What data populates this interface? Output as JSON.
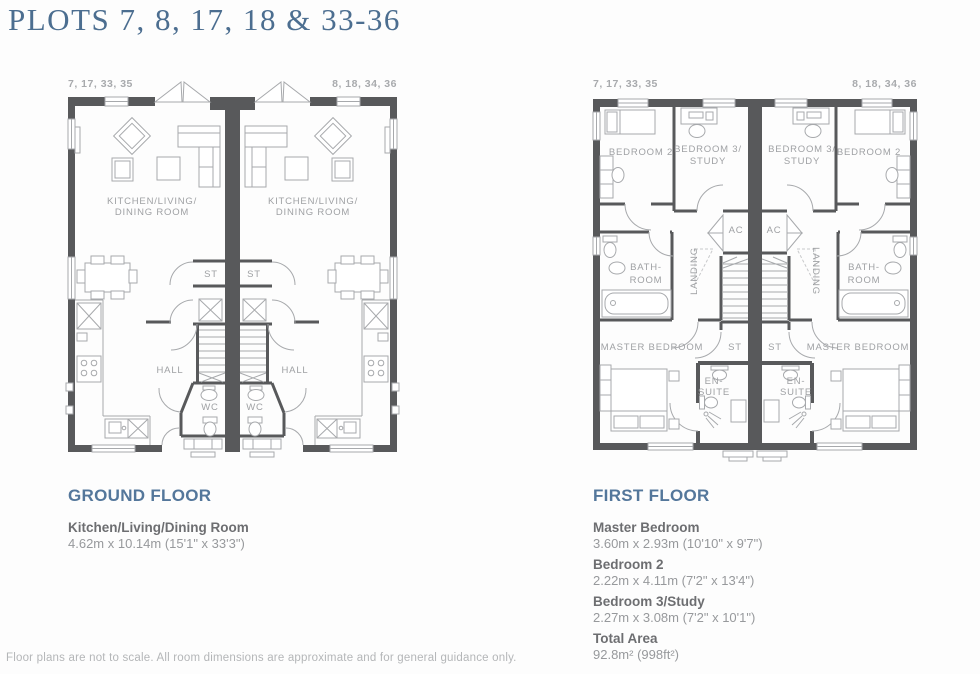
{
  "title": "PLOTS 7, 8, 17, 18 & 33-36",
  "plots": {
    "left": "7, 17, 33, 35",
    "right": "8, 18, 34, 36"
  },
  "ground_floor": {
    "heading": "GROUND FLOOR",
    "labels": {
      "kitchen_line1": "KITCHEN/LIVING/",
      "kitchen_line2": "DINING ROOM",
      "st": "ST",
      "hall": "HALL",
      "wc": "WC"
    },
    "dimensions": [
      {
        "name": "Kitchen/Living/Dining Room",
        "size": "4.62m x 10.14m (15'1\" x 33'3\")"
      }
    ]
  },
  "first_floor": {
    "heading": "FIRST FLOOR",
    "labels": {
      "bedroom2": "BEDROOM 2",
      "bedroom3_line1": "BEDROOM 3/",
      "bedroom3_line2": "STUDY",
      "ac": "AC",
      "landing": "LANDING",
      "bath_line1": "BATH-",
      "bath_line2": "ROOM",
      "master_bedroom": "MASTER BEDROOM",
      "st": "ST",
      "ensuite_line1": "EN-",
      "ensuite_line2": "SUITE"
    },
    "dimensions": [
      {
        "name": "Master Bedroom",
        "size": "3.60m x 2.93m (10'10\" x 9'7\")"
      },
      {
        "name": "Bedroom 2",
        "size": "2.22m x 4.11m (7'2\" x 13'4\")"
      },
      {
        "name": "Bedroom 3/Study",
        "size": "2.27m x 3.08m (7'2\" x 10'1\")"
      },
      {
        "name": "Total Area",
        "size": "92.8m² (998ft²)"
      }
    ]
  },
  "footer": "Floor plans are not to scale. All room dimensions are approximate and for general guidance only.",
  "colors": {
    "accent": "#54779b",
    "wall": "#58595b",
    "line": "#a7a9ac",
    "room_label": "#9fa1a4"
  }
}
